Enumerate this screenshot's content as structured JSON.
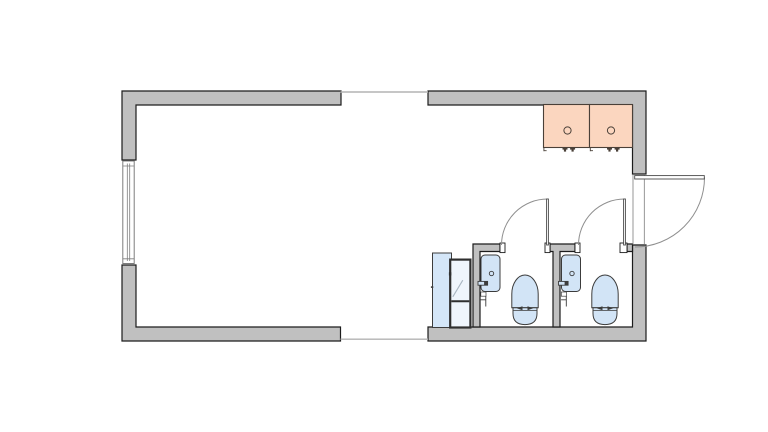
{
  "canvas": {
    "width": 768,
    "height": 432,
    "background": "#ffffff"
  },
  "colors": {
    "background": "#ffffff",
    "wall_fill": "#c0c0c0",
    "wall_stroke": "#1c1c1c",
    "opening_fill": "#ffffff",
    "window_stroke": "#7d7d7d",
    "joint_line": "#b3b3b3",
    "desk_fill": "#fbd6bf",
    "desk_stroke": "#4a4038",
    "fixture_fill": "#d2e4f6",
    "fixture_stroke": "#3c3c3c",
    "door_arc": "#8f8f8f",
    "leaf_stroke": "#4a4a4a",
    "frame_stroke": "#2f2f2f",
    "glass_fill": "#d4e6f8",
    "glass_light": "#eff5fc",
    "glass_diagonal": "#a9b6c1"
  },
  "plan": {
    "drawing_type": "architectural-floor-plan",
    "rooms": [
      {
        "name": "main-room"
      },
      {
        "name": "entry-area"
      },
      {
        "name": "wc-stall-1"
      },
      {
        "name": "wc-stall-2"
      }
    ],
    "inventory": {
      "desks": 2,
      "desk_grommets": 2,
      "sinks": 2,
      "toilets": 2,
      "glass_utility_doors": 1,
      "exterior_doors": 1,
      "stall_doors": 2,
      "windows": 1,
      "module_joints": 2
    }
  }
}
